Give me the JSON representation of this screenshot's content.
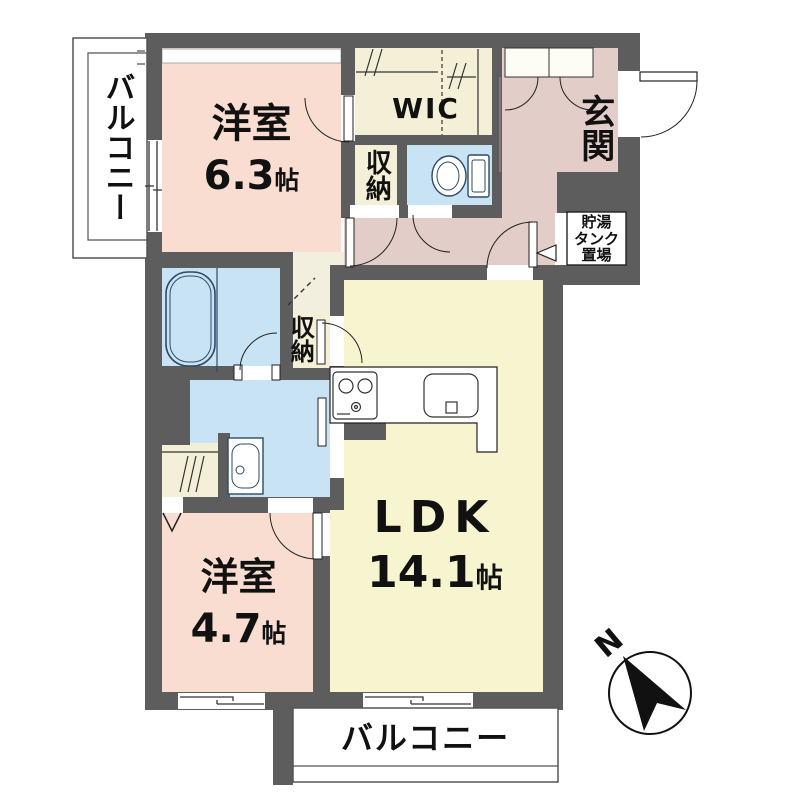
{
  "floorplan": {
    "rooms": {
      "bedroom1": {
        "name": "洋室",
        "area_num": "6.3",
        "area_unit": "帖"
      },
      "bedroom2": {
        "name": "洋室",
        "area_num": "4.7",
        "area_unit": "帖"
      },
      "ldk": {
        "name": "LDK",
        "area_num": "14.1",
        "area_unit": "帖"
      },
      "wic": {
        "name": "WIC"
      },
      "genkan": {
        "name": "玄関"
      },
      "storage_upper": {
        "name": "収納"
      },
      "storage_middle": {
        "name": "収納"
      },
      "tank": {
        "line1": "貯湯",
        "line2": "タンク",
        "line3": "置場"
      },
      "balcony_left": {
        "name": "バルコニー"
      },
      "balcony_bottom": {
        "name": "バルコニー"
      }
    },
    "compass": {
      "label": "N"
    },
    "colors": {
      "wall": "#5d5d5d",
      "bedroom": "#f8ddd0",
      "ldk": "#f7f5cf",
      "storage": "#f4f0d8",
      "entrance": "#e2cdc9",
      "wet_area": "#c8e3f4",
      "balcony": "#ffffff"
    }
  }
}
